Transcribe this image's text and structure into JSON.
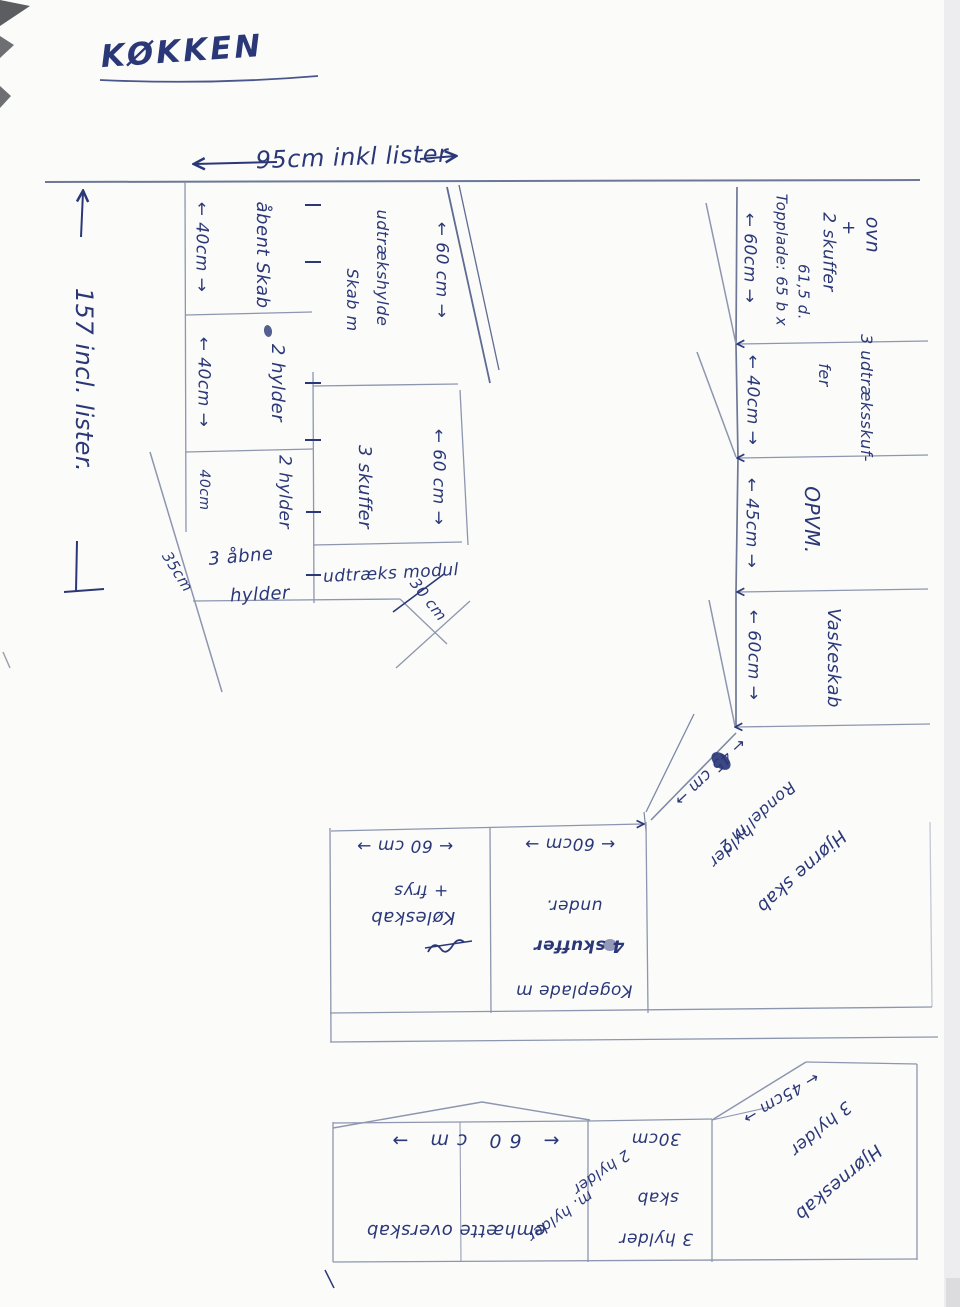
{
  "title": "KØKKEN",
  "colors": {
    "ink": "#2b3878",
    "ruled_line": "#8d96af",
    "paper": "#fbfbfa"
  },
  "dims": {
    "top": "95cm inkl lister",
    "left": "157 incl. lister.",
    "d40a": "← 40cm →",
    "d40b": "← 40cm →",
    "d40c": "40cm",
    "d60top": "← 60 cm →",
    "d60mid": "← 60 cm →",
    "d35": "35cm",
    "d30": "30 cm"
  },
  "tall": {
    "open_cab": "åbent Skab",
    "skab_m": "Skab m",
    "udtraekshylde": "udtrækshylde",
    "shelves2a": "2 hylder",
    "shelves2b": "2 hylder",
    "drawers3": "3 skuffer",
    "open3a": "3 åbne",
    "open3b": "hylder",
    "pullout": "udtræks modul"
  },
  "right_col": {
    "r1_dim": "← 60cm →",
    "r1_top1": "Topplade: 65 b x",
    "r1_top2": "61,5 d.",
    "r1_l1": "ovn",
    "r1_l2": "+",
    "r1_l3": "2 skuffer",
    "r2_dim": "← 40cm →",
    "r2_l1": "3 udtræksskuf-",
    "r2_l2": "fer",
    "r3_dim": "← 45cm →",
    "r3_l": "OPVM.",
    "r4_dim": "← 60cm →",
    "r4_l": "Vaskeskab"
  },
  "corner1": {
    "dim": "← 45 cm →",
    "l1": "Rondel m 2",
    "l2": "hylder",
    "l3": "Hjørne skab"
  },
  "mid": {
    "fridge_dim": "← 60 cm →",
    "fridge_l1": "+ frys",
    "fridge_l2": "Køleskab",
    "hob_dim": "← 60cm →",
    "hob_l1": "under.",
    "hob_l2": "4 skuffer",
    "hob_l3": "Kogeplade m"
  },
  "bottom": {
    "hood_dim": "← 60 cm →",
    "hood_l": "emhætte overskab",
    "hood_n1": "m. hylder",
    "hood_n2": "2 hylder",
    "s30_dim": "30cm",
    "s30_l1": "skab",
    "s30_l2": "3 hylder",
    "c_dim": "← 45cm →",
    "c_l1": "3 hylder",
    "c_l2": "Hjørneskab"
  }
}
